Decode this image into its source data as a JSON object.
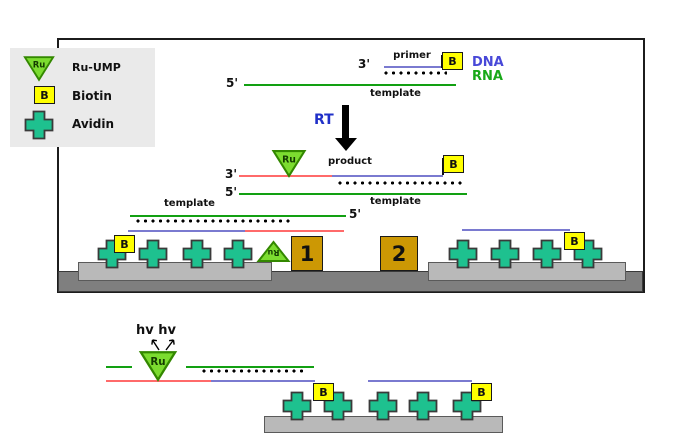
{
  "symbols": {
    "ru": "Ru",
    "b": "B"
  },
  "legend": {
    "ru_ump": "Ru-UMP",
    "biotin": "Biotin",
    "avidin": "Avidin"
  },
  "labels": {
    "three_prime": "3'",
    "five_prime": "5'",
    "primer": "primer",
    "template": "template",
    "product": "product",
    "dna": "DNA",
    "rna": "RNA",
    "rt": "RT",
    "hv": "hv hv"
  },
  "boxes": {
    "box1": "1",
    "box2": "2"
  },
  "colors": {
    "ru_green": "#7cdc30",
    "biotin_yellow": "#ffff00",
    "avidin_teal": "#1ec18f",
    "dna_line_blue": "#7a7ad0",
    "rna_line_green": "#12a012",
    "product_red": "#ff6a6a",
    "dna_text": "#4848d8",
    "rna_text": "#18a818",
    "rt_text": "#2030c8",
    "electrode_gold": "#cc9804",
    "platform_gray": "#b9b9b9",
    "floor_gray": "#7f7f7f"
  }
}
